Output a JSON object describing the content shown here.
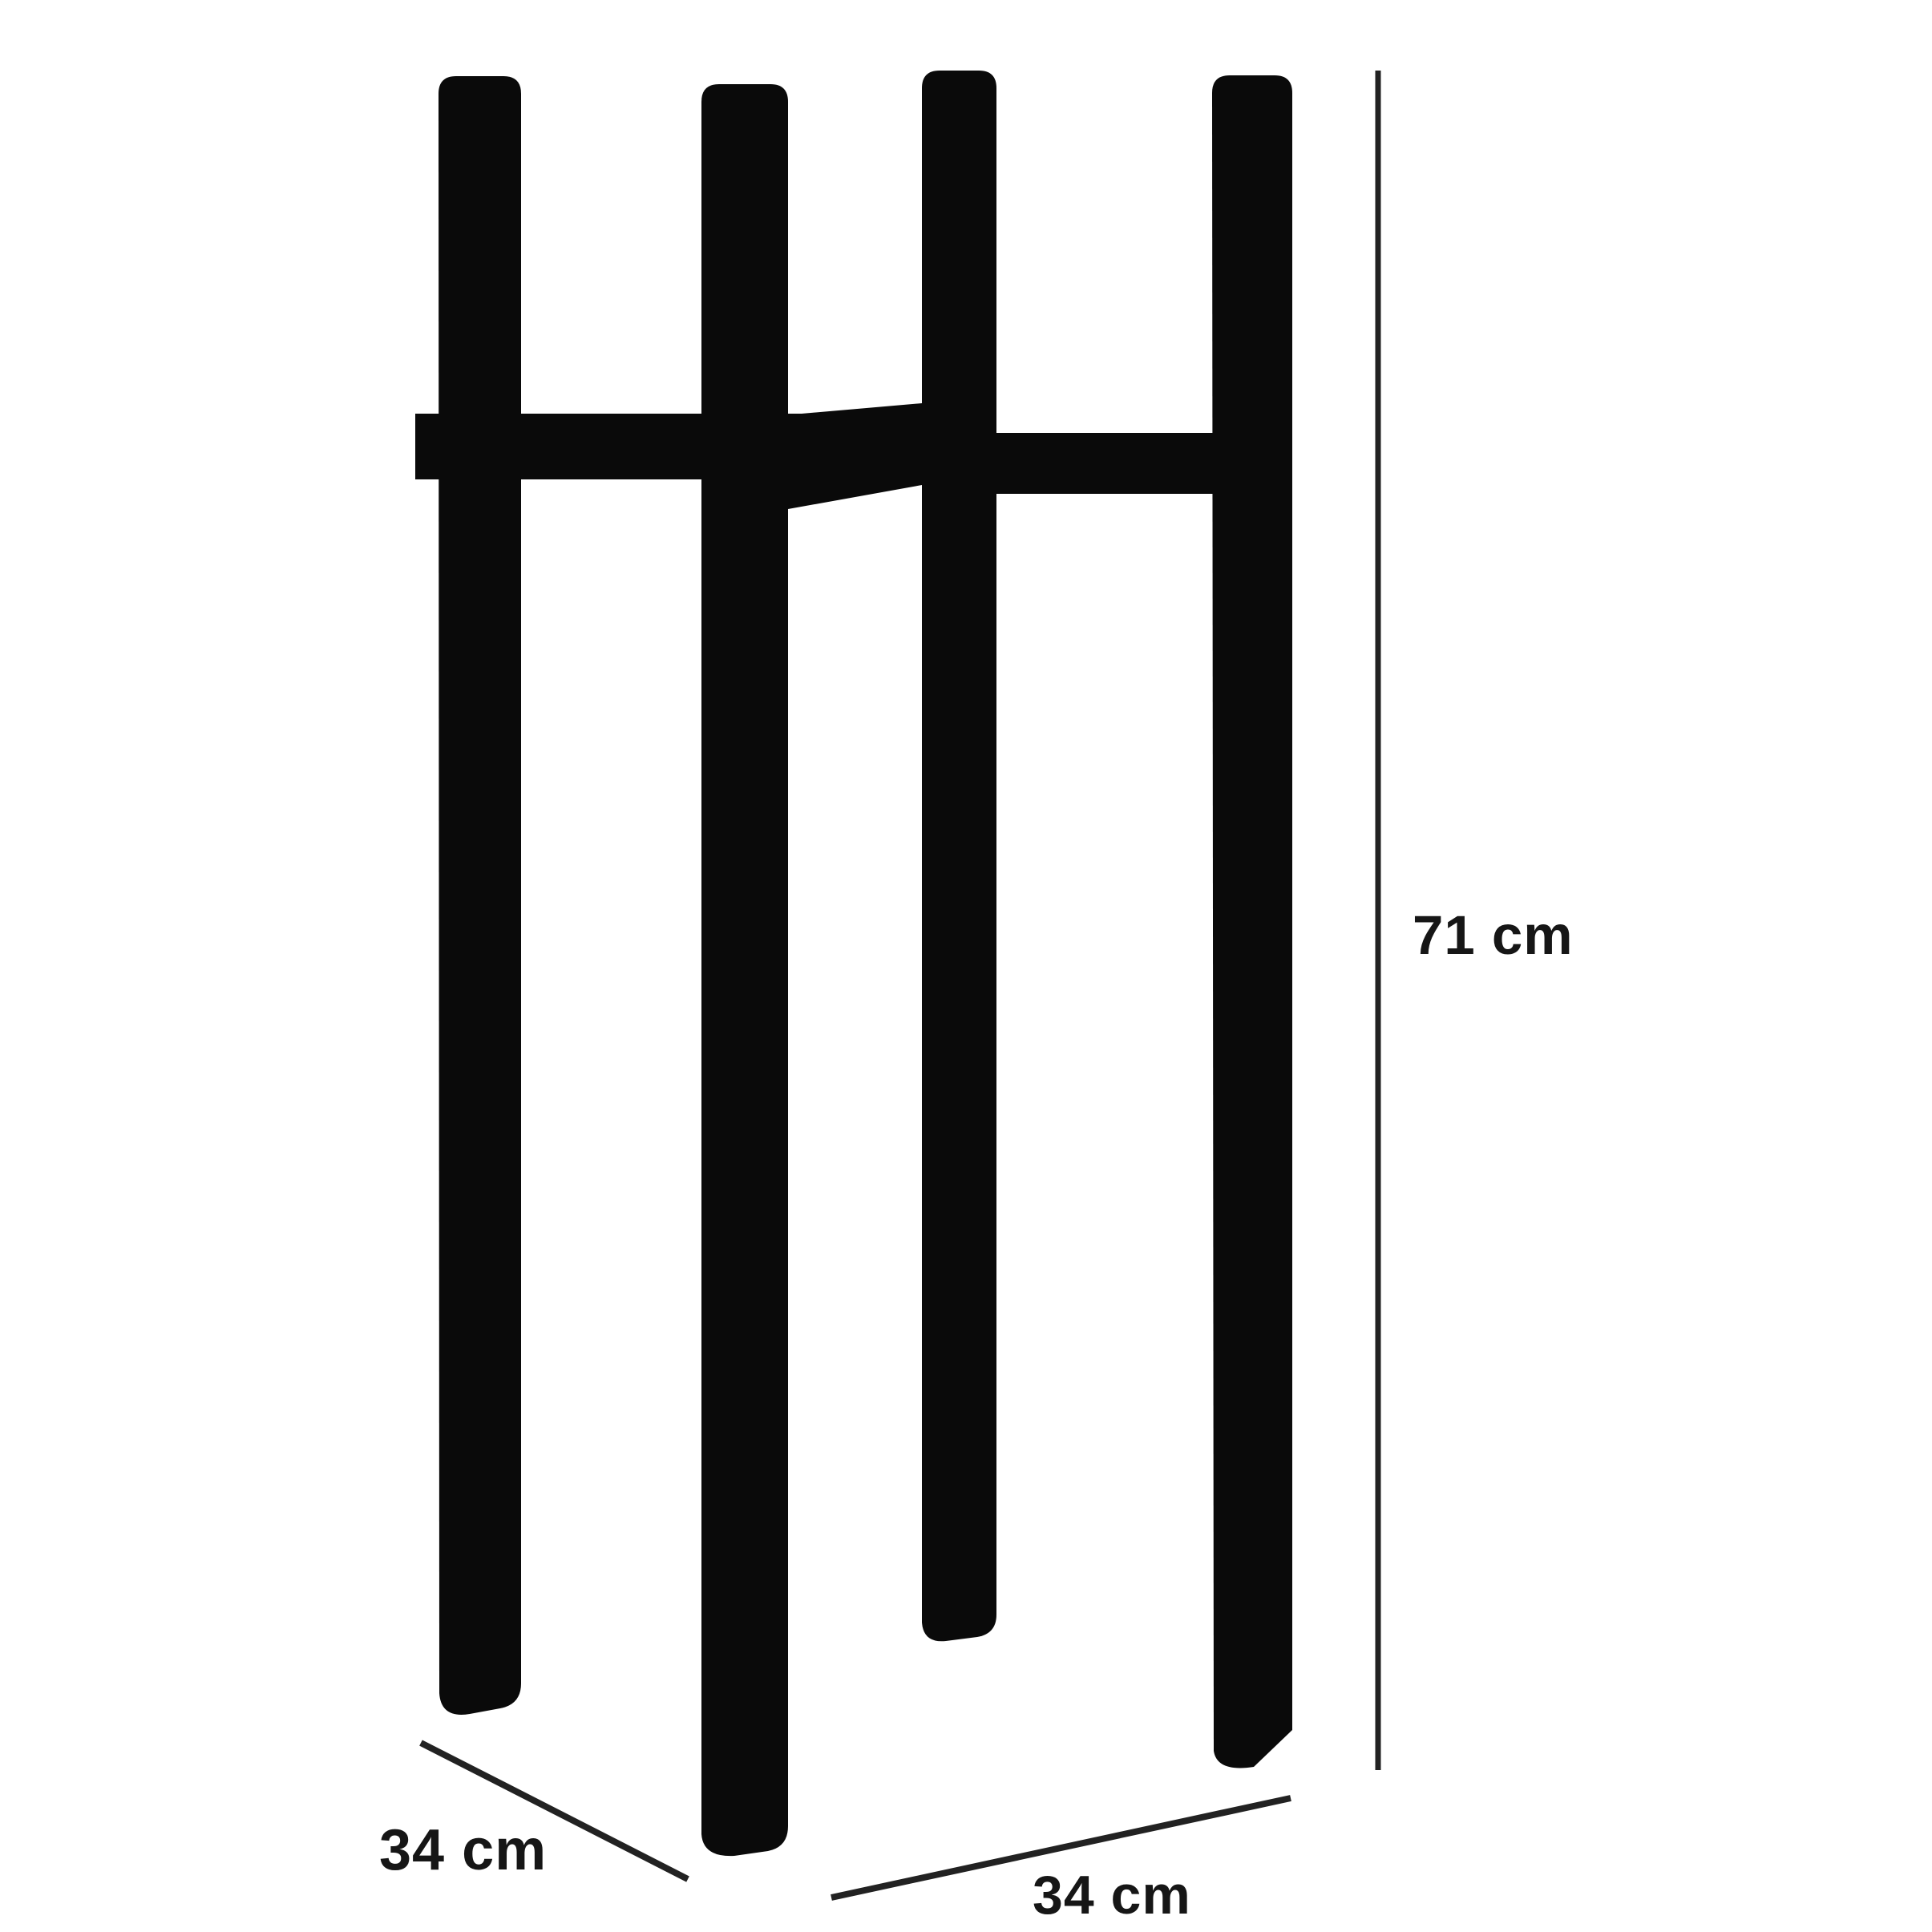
{
  "figure": {
    "background": "#ffffff",
    "ink": "#0a0a0a",
    "line": "#222222",
    "text_color": "#161616",
    "labels": {
      "height": "71 cm",
      "depth": "34 cm",
      "width": "34 cm"
    },
    "values": {
      "height_cm": 71,
      "depth_cm": 34,
      "width_cm": 34,
      "unit": "cm"
    }
  }
}
